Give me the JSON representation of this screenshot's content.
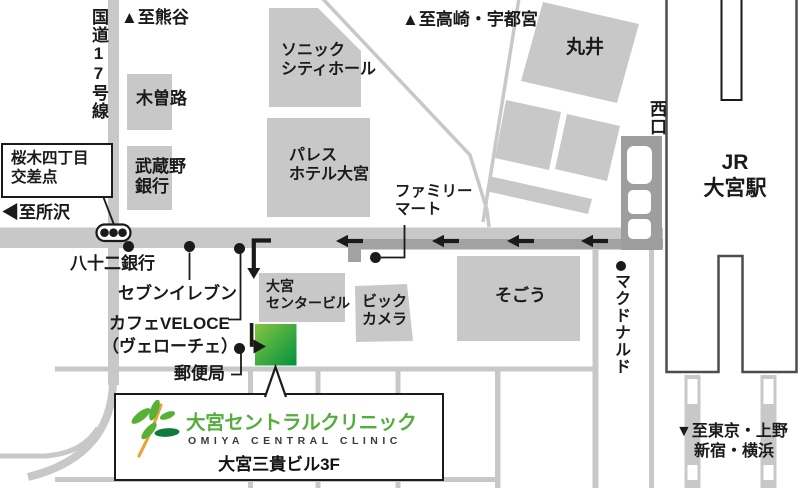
{
  "signs": {
    "to_kumagaya": "▲至熊谷",
    "to_takasaki_utsunomiya": "▲至高崎・宇都宮",
    "to_tokorozawa": "◀至所沢",
    "to_tokyo_ueno": "▼至東京・上野",
    "to_shinjuku_yokohama": "新宿・横浜",
    "route17": "国道17号線",
    "intersection_line1": "桜木四丁目",
    "intersection_line2": "交差点"
  },
  "station": {
    "jr": "JR",
    "name": "大宮駅",
    "west_exit": "西口"
  },
  "landmarks": {
    "kisoji": "木曽路",
    "musashino_bank_l1": "武蔵野",
    "musashino_bank_l2": "銀行",
    "sonic_l1": "ソニック",
    "sonic_l2": "シティホール",
    "palace_l1": "パレス",
    "palace_l2": "ホテル大宮",
    "marui": "丸井",
    "family_mart_l1": "ファミリー",
    "family_mart_l2": "マート",
    "hachijuni_bank": "八十二銀行",
    "seven_eleven": "セブンイレブン",
    "cafe_veloce_l1": "カフェVELOCE",
    "cafe_veloce_l2": "（ヴェローチェ）",
    "post_office": "郵便局",
    "omiya_center_building_l1": "大宮",
    "omiya_center_building_l2": "センタービル",
    "bic_camera_l1": "ビック",
    "bic_camera_l2": "カメラ",
    "sogo": "そごう",
    "mcdonalds": "マクドナルド"
  },
  "clinic": {
    "name_ja": "大宮セントラルクリニック",
    "name_en": "OMIYA CENTRAL CLINIC",
    "address": "大宮三貴ビル3F"
  },
  "colors": {
    "building_gray": "#c8c8c8",
    "road_dark_gray": "#a2a2a2",
    "station_line": "#4d4d4d",
    "ink": "#1a1a1a",
    "clinic_green_light": "#85c440",
    "clinic_green_dark": "#009240",
    "logo_green": "#53ae3b",
    "logo_orange": "#e8a33c"
  }
}
